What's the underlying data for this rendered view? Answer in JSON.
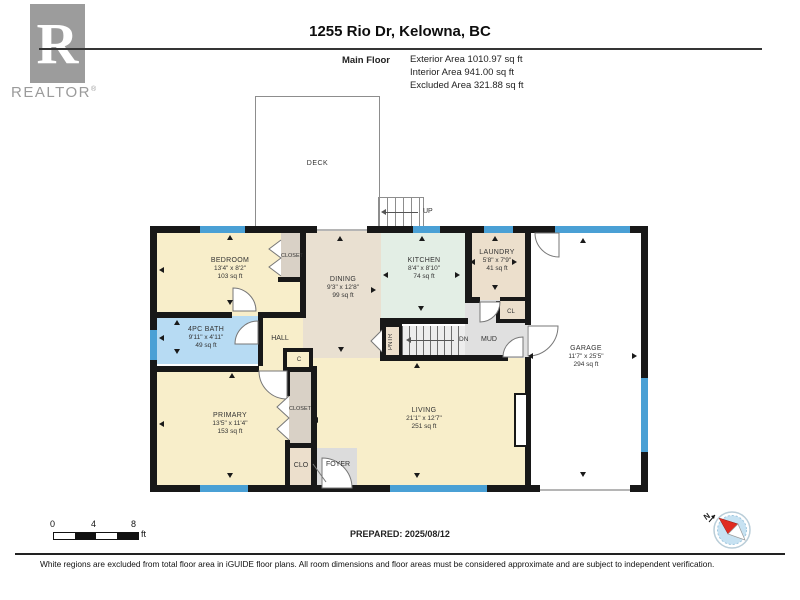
{
  "header": {
    "title": "1255 Rio Dr, Kelowna, BC",
    "floor_label": "Main Floor",
    "stats": {
      "exterior": "Exterior Area 1010.97 sq ft",
      "interior": "Interior Area 941.00 sq ft",
      "excluded": "Excluded Area 321.88 sq ft"
    }
  },
  "logo": {
    "letter": "R",
    "brand": "REALTOR",
    "reg": "®"
  },
  "rooms": {
    "deck": {
      "name": "DECK"
    },
    "bedroom": {
      "name": "BEDROOM",
      "dims": "13'4\" x 8'2\"",
      "area": "103 sq ft"
    },
    "bedroom_closet": {
      "name": "CLOSET"
    },
    "bath": {
      "name": "4PC BATH",
      "dims": "9'11\" x 4'11\"",
      "area": "49 sq ft"
    },
    "hall": {
      "name": "HALL"
    },
    "c_closet": {
      "name": "C"
    },
    "primary": {
      "name": "PRIMARY",
      "dims": "13'5\" x 11'4\"",
      "area": "153 sq ft"
    },
    "primary_closet": {
      "name": "CLOSET"
    },
    "clo": {
      "name": "CLO"
    },
    "dining": {
      "name": "DINING",
      "dims": "9'3\" x 12'8\"",
      "area": "99 sq ft"
    },
    "kitchen": {
      "name": "KITCHEN",
      "dims": "8'4\" x 8'10\"",
      "area": "74 sq ft"
    },
    "laundry": {
      "name": "LAUNDRY",
      "dims": "5'8\" x 7'9\"",
      "area": "41 sq ft"
    },
    "cl": {
      "name": "CL"
    },
    "mud": {
      "name": "MUD"
    },
    "pntr": {
      "name": "PNTR"
    },
    "living": {
      "name": "LIVING",
      "dims": "21'1\" x 12'7\"",
      "area": "251 sq ft"
    },
    "garage": {
      "name": "GARAGE",
      "dims": "11'7\" x 25'5\"",
      "area": "294 sq ft"
    },
    "foyer": {
      "name": "FOYER"
    }
  },
  "stairs": {
    "up": "UP",
    "down": "DN"
  },
  "scalebar": {
    "t0": "0",
    "t1": "4",
    "t2": "8",
    "unit": "ft"
  },
  "compass": {
    "north": "N"
  },
  "footer": {
    "prepared": "PREPARED: 2025/08/12",
    "disclaimer": "White regions are excluded from total floor area in iGUIDE floor plans. All room dimensions and floor areas must be considered approximate and are subject to independent verification."
  },
  "colors": {
    "wall": "#181818",
    "window_blue": "#4aa0d5",
    "room_cream": "#f8eeca",
    "room_tan": "#e9e0d1",
    "room_mint": "#e3eee5",
    "room_bath_blue": "#b7dbf3",
    "closet_taupe": "#d9d1c6",
    "circulation_gray": "#e0e0e0",
    "compass_red": "#e02b20",
    "logo_gray": "#9c9c9c"
  }
}
